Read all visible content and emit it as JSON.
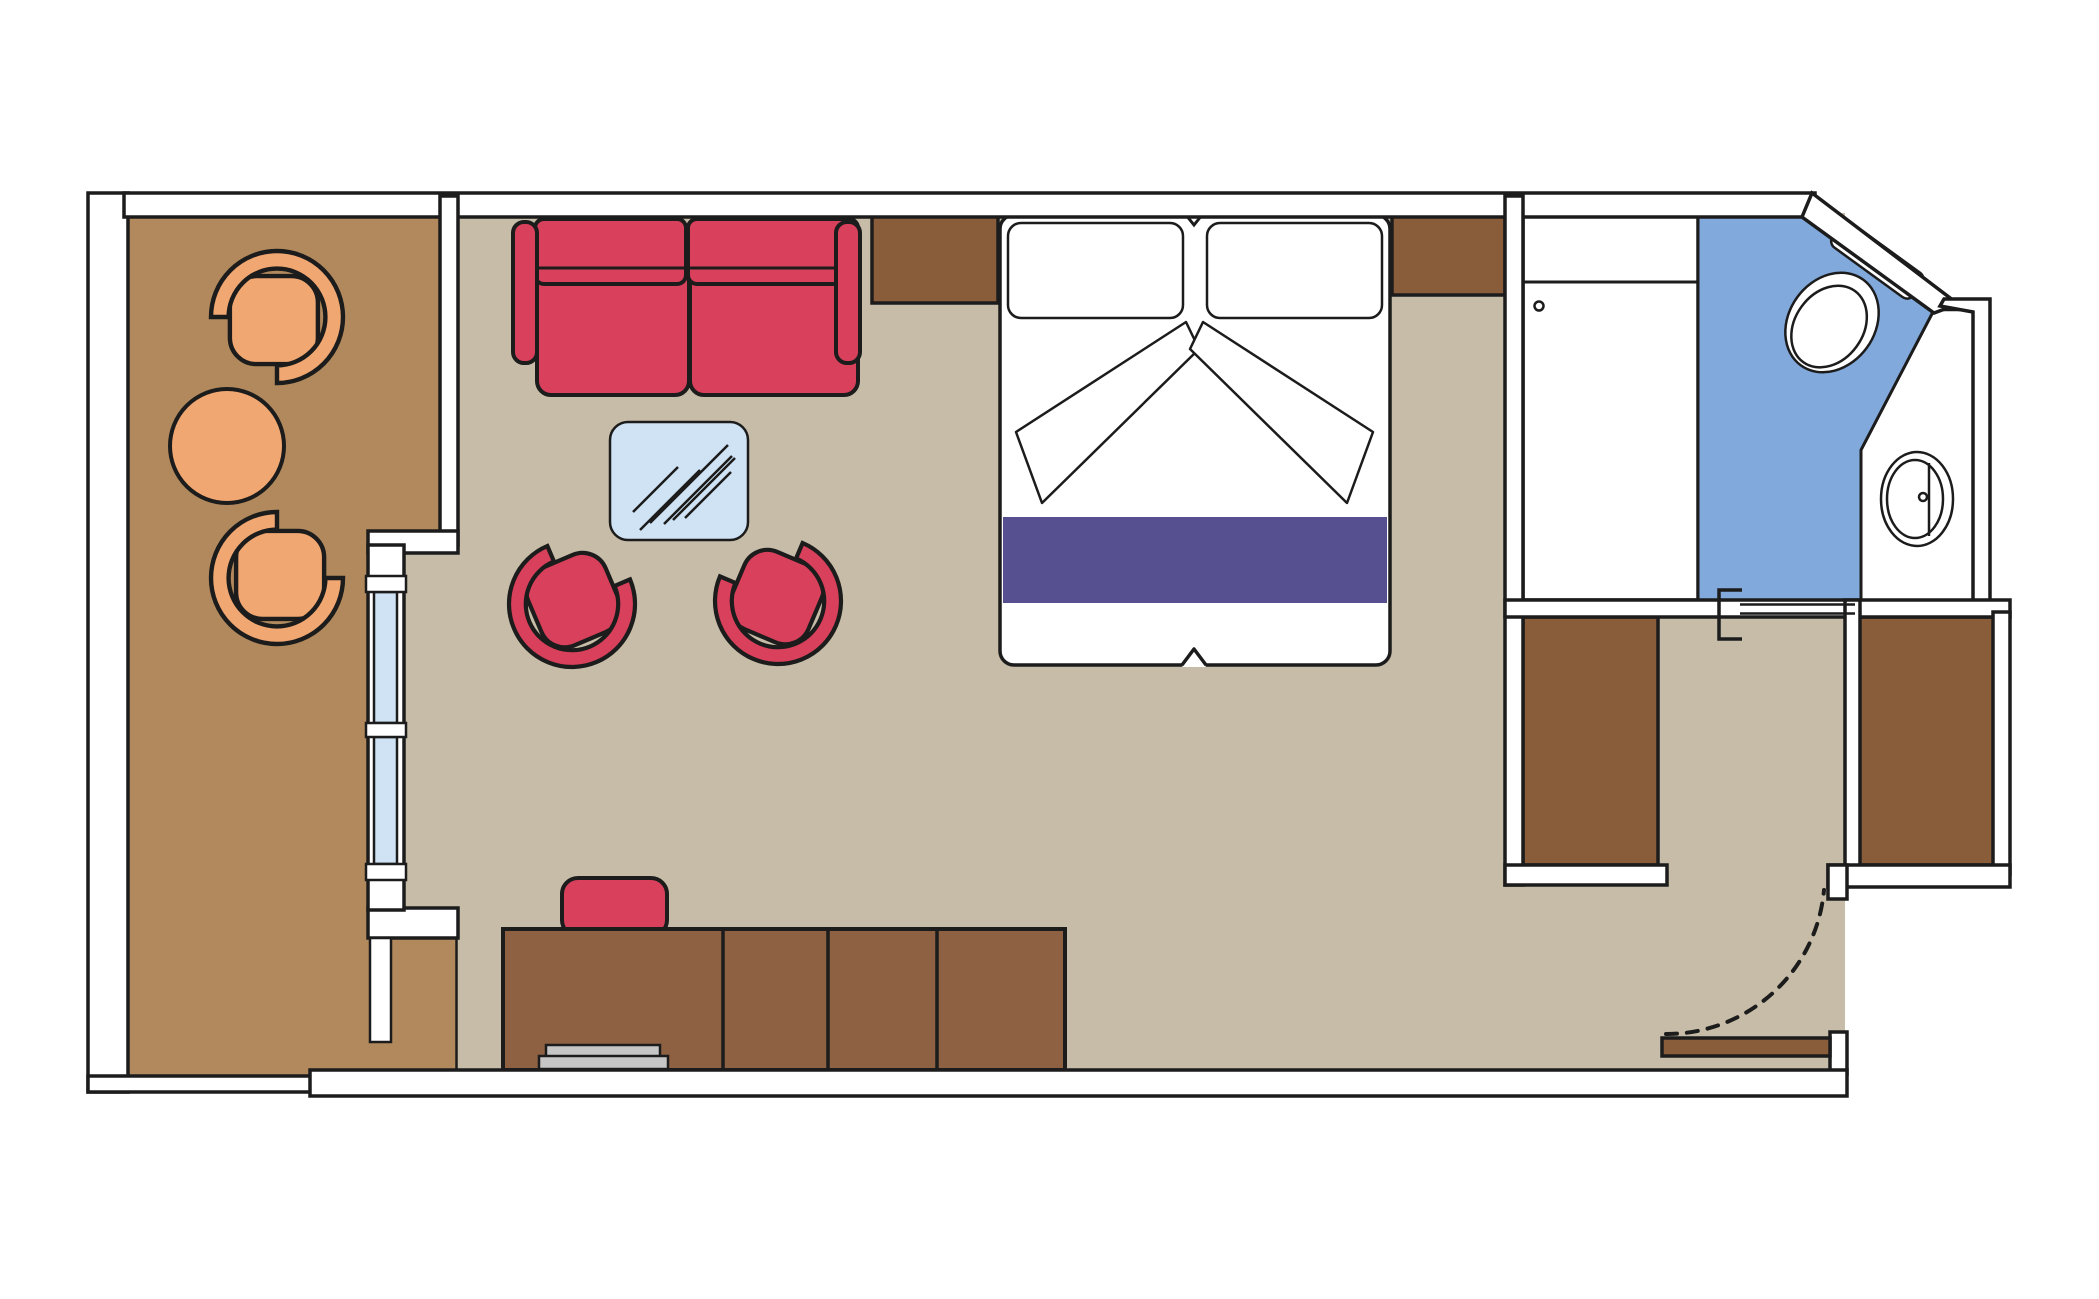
{
  "colors": {
    "page_bg": "#ffffff",
    "wall_fill": "#ffffff",
    "line": "#1c1c1c",
    "floor_main": "#c6bca7",
    "floor_balcony": "#b1895c",
    "furniture_brown": "#8a5d3a",
    "desk_brown": "#8d6141",
    "accent_red": "#d8405b",
    "chair_orange": "#f0a771",
    "bathroom_blue": "#81a9dc",
    "glass_blue": "#cfe3f5",
    "runner_purple": "#575090",
    "hardware_gray": "#c6c6c6",
    "mattress_white": "#ffffff"
  },
  "plan": {
    "type": "floorplan",
    "description_icon": "cruise-cabin-floorplan",
    "rooms": [
      {
        "id": "balcony",
        "floor_color_key": "floor_balcony",
        "furniture": [
          "tub-chair",
          "tub-chair",
          "round-table"
        ]
      },
      {
        "id": "living-sleeping-area",
        "floor_color_key": "floor_main",
        "furniture": [
          "sofa",
          "coffee-table",
          "tub-chair",
          "tub-chair",
          "double-bed",
          "wall-cabinet",
          "wall-cabinet",
          "desk",
          "desk-chair",
          "cabinet-row"
        ]
      },
      {
        "id": "bathroom",
        "floor_color_key": "bathroom_blue",
        "furniture": [
          "shower-closet",
          "toilet",
          "sink"
        ]
      },
      {
        "id": "wardrobe-corridor",
        "floor_color_key": "floor_main",
        "furniture": [
          "wardrobe",
          "wardrobe"
        ]
      },
      {
        "id": "entrance",
        "floor_color_key": "floor_main",
        "furniture": [
          "entry-door"
        ]
      }
    ],
    "doors": [
      "balcony-sliding-door",
      "bathroom-sliding-door",
      "entry-swing-door"
    ],
    "windows": [
      "balcony-window-two-panes"
    ],
    "bed": {
      "pillows": 2,
      "runner_color_key": "runner_purple",
      "sheets": "v-folded"
    }
  }
}
